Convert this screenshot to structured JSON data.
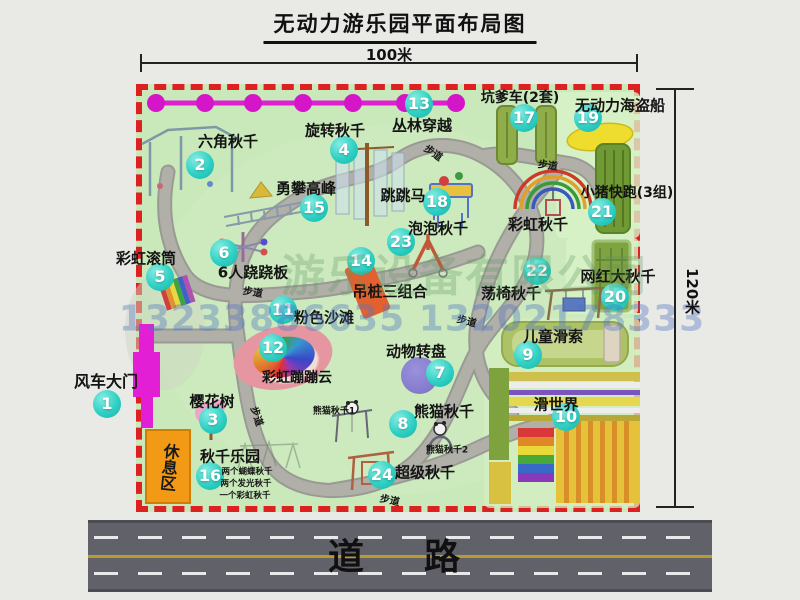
{
  "title": "无动力游乐园平面布局图",
  "dimensions": {
    "width_label": "100米",
    "height_label": "120米"
  },
  "road_label": "道　路",
  "watermark": {
    "company": "游乐设备有限公司",
    "phone": "13233886635 13202178333"
  },
  "rest_area_label": "休息区",
  "colors": {
    "badge_teal": "#2fd0c4",
    "border_red": "#dd2020",
    "map_green": "#c9e9ba",
    "gate_magenta": "#e31fd6",
    "road_gray": "#61616a",
    "rest_orange": "#f29a16"
  },
  "map": {
    "items": [
      {
        "num": "1",
        "label": "风车大门",
        "x": 107,
        "y": 404,
        "lx": 106,
        "ly": 380,
        "fs": 16
      },
      {
        "num": "2",
        "label": "六角秋千",
        "x": 200,
        "y": 165,
        "lx": 228,
        "ly": 141,
        "fs": 15
      },
      {
        "num": "3",
        "label": "樱花树",
        "x": 213,
        "y": 420,
        "lx": 212,
        "ly": 401,
        "fs": 15
      },
      {
        "num": "4",
        "label": "旋转秋千",
        "x": 344,
        "y": 150,
        "lx": 335,
        "ly": 130,
        "fs": 15
      },
      {
        "num": "5",
        "label": "彩虹滚筒",
        "x": 160,
        "y": 277,
        "lx": 146,
        "ly": 258,
        "fs": 15
      },
      {
        "num": "6",
        "label": "6人跷跷板",
        "x": 224,
        "y": 253,
        "lx": 253,
        "ly": 272,
        "fs": 15
      },
      {
        "num": "7",
        "label": "动物转盘",
        "x": 440,
        "y": 373,
        "lx": 416,
        "ly": 351,
        "fs": 15
      },
      {
        "num": "8",
        "label": "熊猫秋千",
        "x": 403,
        "y": 424,
        "lx": 444,
        "ly": 411,
        "fs": 15
      },
      {
        "num": "9",
        "label": "儿童滑索",
        "x": 528,
        "y": 355,
        "lx": 553,
        "ly": 336,
        "fs": 15
      },
      {
        "num": "10",
        "label": "滑世界",
        "x": 566,
        "y": 417,
        "lx": 556,
        "ly": 404,
        "fs": 15
      },
      {
        "num": "11",
        "label": "粉色沙滩",
        "x": 283,
        "y": 310,
        "lx": 324,
        "ly": 317,
        "fs": 15
      },
      {
        "num": "12",
        "label": "彩虹蹦蹦云",
        "x": 273,
        "y": 348,
        "lx": 297,
        "ly": 377,
        "fs": 14
      },
      {
        "num": "13",
        "label": "丛林穿越",
        "x": 419,
        "y": 104,
        "lx": 422,
        "ly": 125,
        "fs": 15
      },
      {
        "num": "14",
        "label": "吊桩三组合",
        "x": 361,
        "y": 261,
        "lx": 390,
        "ly": 291,
        "fs": 15
      },
      {
        "num": "15",
        "label": "勇攀高峰",
        "x": 314,
        "y": 208,
        "lx": 306,
        "ly": 188,
        "fs": 15
      },
      {
        "num": "16",
        "label": "秋千乐园",
        "x": 210,
        "y": 476,
        "lx": 230,
        "ly": 456,
        "fs": 15
      },
      {
        "num": "17",
        "label": "坑爹车(2套)",
        "x": 524,
        "y": 118,
        "lx": 520,
        "ly": 97,
        "fs": 14
      },
      {
        "num": "18",
        "label": "跳跳马",
        "x": 437,
        "y": 202,
        "lx": 403,
        "ly": 195,
        "fs": 15
      },
      {
        "num": "19",
        "label": "无动力海盗船",
        "x": 588,
        "y": 118,
        "lx": 620,
        "ly": 105,
        "fs": 15
      },
      {
        "num": "20",
        "label": "网红大秋千",
        "x": 615,
        "y": 297,
        "lx": 618,
        "ly": 276,
        "fs": 15
      },
      {
        "num": "21",
        "label": "小猪快跑(3组)",
        "x": 602,
        "y": 212,
        "lx": 627,
        "ly": 192,
        "fs": 14
      },
      {
        "num": "22",
        "label": "荡椅秋千",
        "x": 537,
        "y": 271,
        "lx": 511,
        "ly": 293,
        "fs": 15
      },
      {
        "num": "23",
        "label": "泡泡秋千",
        "x": 401,
        "y": 242,
        "lx": 438,
        "ly": 228,
        "fs": 15
      },
      {
        "num": "24",
        "label": "超级秋千",
        "x": 382,
        "y": 475,
        "lx": 425,
        "ly": 472,
        "fs": 15
      }
    ],
    "labels": [
      {
        "name": "label-rainbow-swing",
        "text": "彩虹秋千",
        "x": 538,
        "y": 224,
        "fs": 15,
        "rot": 0
      },
      {
        "name": "label-panda-swing-1",
        "text": "熊猫秋千1",
        "x": 334,
        "y": 410,
        "fs": 9,
        "rot": 0
      },
      {
        "name": "label-panda-swing-2",
        "text": "熊猫秋千2",
        "x": 447,
        "y": 449,
        "fs": 9,
        "rot": 0
      },
      {
        "name": "label-swing-park-note-1",
        "text": "两个蝴蝶秋千",
        "x": 247,
        "y": 471,
        "fs": 8.5,
        "rot": 0
      },
      {
        "name": "label-swing-park-note-2",
        "text": "两个发光秋千",
        "x": 246,
        "y": 483,
        "fs": 8.5,
        "rot": 0
      },
      {
        "name": "label-swing-park-note-3",
        "text": "一个彩虹秋千",
        "x": 245,
        "y": 495,
        "fs": 8.5,
        "rot": 0
      },
      {
        "name": "label-footpath",
        "text": "步道",
        "x": 434,
        "y": 152,
        "fs": 10,
        "rot": 35
      },
      {
        "name": "label-footpath",
        "text": "步道",
        "x": 548,
        "y": 164,
        "fs": 10,
        "rot": 8
      },
      {
        "name": "label-footpath",
        "text": "步道",
        "x": 253,
        "y": 291,
        "fs": 10,
        "rot": 10
      },
      {
        "name": "label-footpath",
        "text": "步道",
        "x": 258,
        "y": 416,
        "fs": 10,
        "rot": 72
      },
      {
        "name": "label-footpath",
        "text": "步道",
        "x": 467,
        "y": 320,
        "fs": 10,
        "rot": 15
      },
      {
        "name": "label-footpath",
        "text": "步道",
        "x": 390,
        "y": 499,
        "fs": 10,
        "rot": 12
      }
    ]
  }
}
